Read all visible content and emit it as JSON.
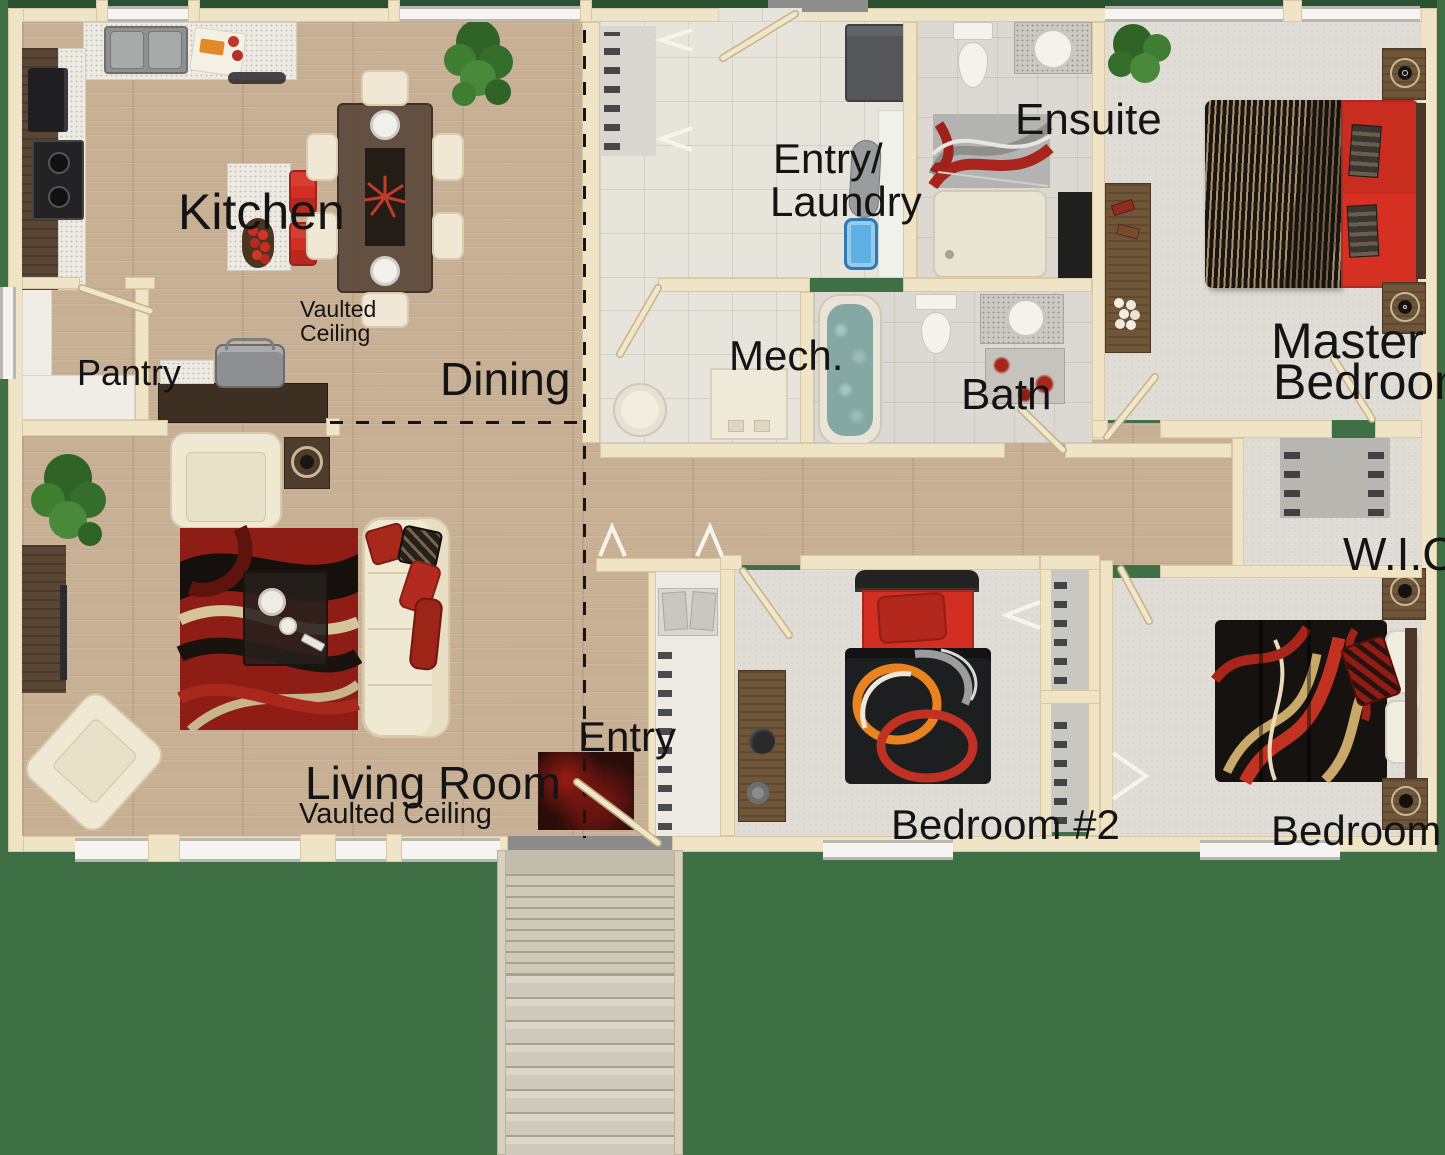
{
  "plan_title": "",
  "rooms": {
    "kitchen": {
      "label": "Kitchen",
      "note_line1": "Vaulted",
      "note_line2": "Ceiling"
    },
    "pantry": {
      "label": "Pantry"
    },
    "dining": {
      "label": "Dining"
    },
    "entry_laundry": {
      "label_line1": "Entry/",
      "label_line2": "Laundry"
    },
    "mech": {
      "label": "Mech."
    },
    "ensuite": {
      "label": "Ensuite"
    },
    "bath": {
      "label": "Bath"
    },
    "master_bedroom": {
      "label_line1": "Master",
      "label_line2": "Bedroom"
    },
    "wic": {
      "label": "W.I.C."
    },
    "living_room": {
      "label": "Living Room",
      "note": "Vaulted Ceiling"
    },
    "entry": {
      "label": "Entry"
    },
    "bedroom_2": {
      "label": "Bedroom #2"
    },
    "bedroom_3": {
      "label": "Bedroom #3"
    }
  },
  "colors": {
    "background_green": "#3e6f45",
    "window_grass_green": "#2a5130",
    "wall_cream": "#f0e4c6",
    "wood_floor": "#c8b095",
    "tile_floor": "#e7e4dc",
    "bath_tile": "#dcd9d3",
    "carpet": "#e0ddd7",
    "accent_red": "#d22f22",
    "dark_duvet": "#1d1e20",
    "furniture_wood": "#6f5639",
    "label_text": "#141414"
  }
}
